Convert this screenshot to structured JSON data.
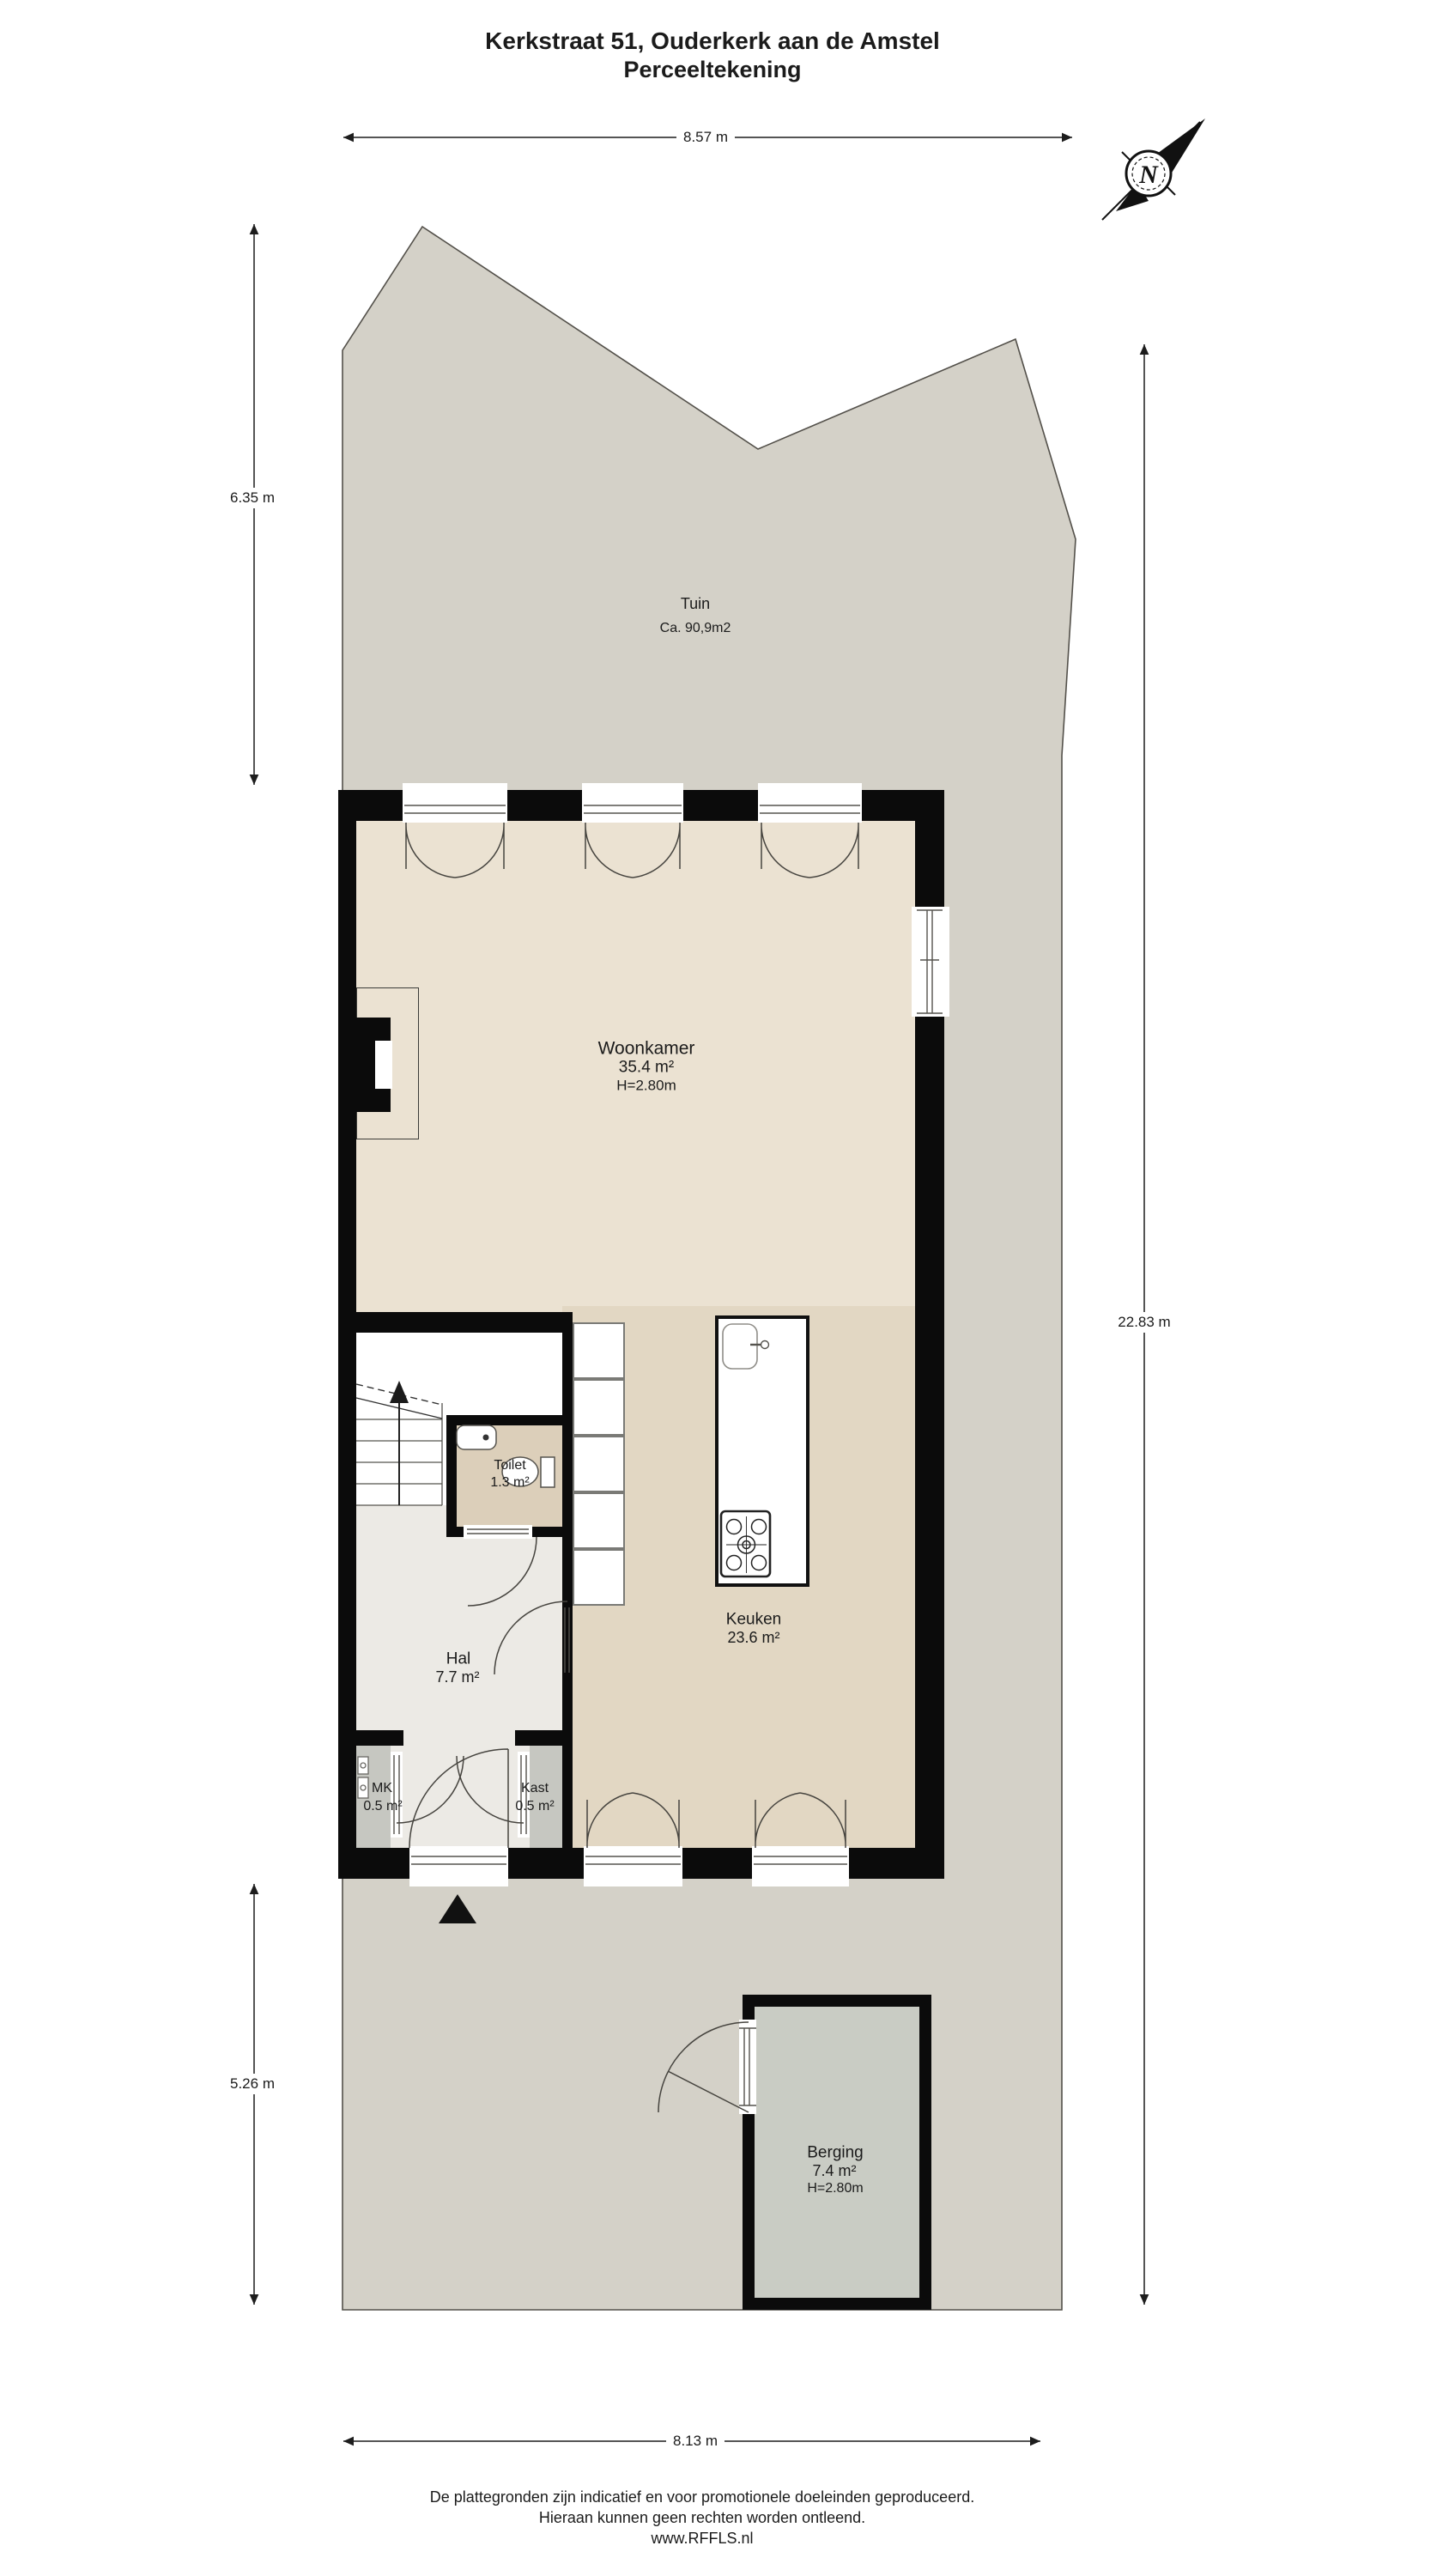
{
  "title": {
    "line1": "Kerkstraat 51, Ouderkerk aan de Amstel",
    "line2": "Perceeltekening"
  },
  "compass": {
    "north_label": "N"
  },
  "dimensions": {
    "top_width": "8.57 m",
    "garden_depth_left": "6.35 m",
    "total_depth_right": "22.83 m",
    "front_depth_left": "5.26 m",
    "bottom_width": "8.13 m"
  },
  "garden": {
    "name": "Tuin",
    "area": "Ca. 90,9m2"
  },
  "rooms": {
    "woonkamer": {
      "name": "Woonkamer",
      "area": "35.4 m²",
      "height": "H=2.80m"
    },
    "keuken": {
      "name": "Keuken",
      "area": "23.6 m²"
    },
    "toilet": {
      "name": "Toilet",
      "area": "1.3 m²"
    },
    "hal": {
      "name": "Hal",
      "area": "7.7 m²"
    },
    "mk": {
      "name": "MK",
      "area": "0.5 m²"
    },
    "kast": {
      "name": "Kast",
      "area": "0.5 m²"
    },
    "berging": {
      "name": "Berging",
      "area": "7.4 m²",
      "height": "H=2.80m"
    }
  },
  "footer": {
    "line1": "De plattegronden zijn indicatief en voor promotionele doeleinden geproduceerd.",
    "line2": "Hieraan kunnen geen rechten worden ontleend.",
    "line3": "www.RFFLS.nl"
  },
  "palette": {
    "garden": "#d4d1c8",
    "woonkamer_floor": "#ebe2d2",
    "keuken_floor": "#e2d7c3",
    "hal_floor": "#eceae5",
    "toilet_floor": "#dccfba",
    "closet_floor": "#c6c7c1",
    "berging_floor": "#c9ccc4",
    "wall": "#0b0b0b"
  }
}
